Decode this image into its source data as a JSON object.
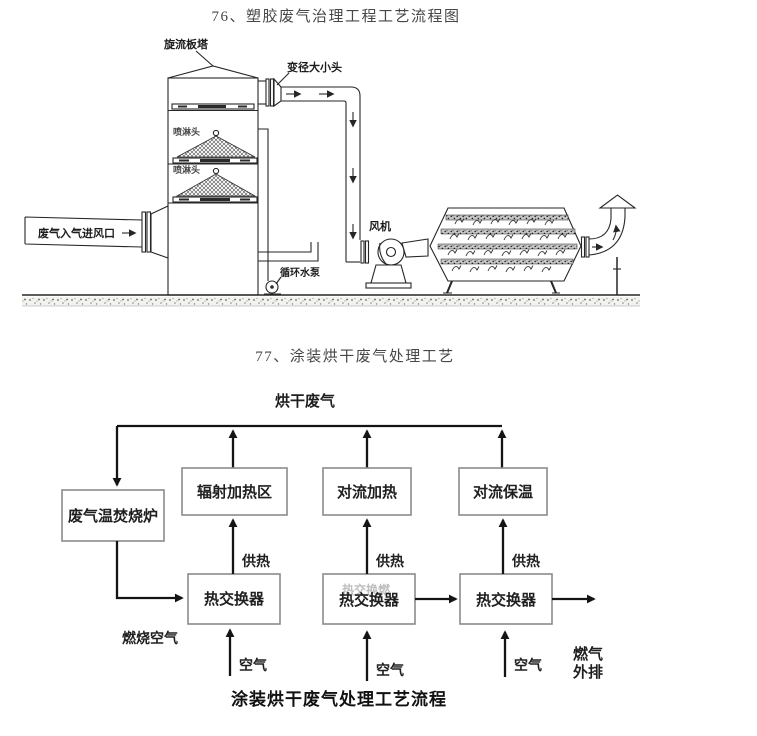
{
  "page": {
    "background": "#ffffff"
  },
  "figure76": {
    "title": "76、塑胶废气治理工程工艺流程图",
    "labels": {
      "tower": "旋流板塔",
      "reducer": "变径大小头",
      "spray_head_1": "喷淋头",
      "spray_head_2": "喷淋头",
      "gas_inlet": "废气入气进风口",
      "circulating_pump": "循环水泵",
      "fan": "风机"
    }
  },
  "figure77": {
    "title": "77、涂装烘干废气处理工艺",
    "drying_gas_label": "烘干废气",
    "boxes": {
      "incinerator": "废气温焚烧炉",
      "radiant_zone": "辐射加热区",
      "convection_heating": "对流加热",
      "convection_holding": "对流保温",
      "heat_exchanger_1": "热交换器",
      "heat_exchanger_2": "热交换器",
      "heat_exchanger_2_ghost": "热交换燃",
      "heat_exchanger_3": "热交换器"
    },
    "labels": {
      "heat_supply_1": "供热",
      "heat_supply_2": "供热",
      "heat_supply_3": "供热",
      "combustion_air": "燃烧空气",
      "air_1": "空气",
      "air_2": "空气",
      "air_3": "空气",
      "exhaust_line_1": "燃气",
      "exhaust_line_2": "外排"
    },
    "caption": "涂装烘干废气处理工艺流程"
  },
  "colors": {
    "diagram_line": "#262626",
    "flow_line": "#141414",
    "box_border": "#8b8b8b",
    "title_text": "#474747",
    "label_text": "#1c1c1c"
  }
}
